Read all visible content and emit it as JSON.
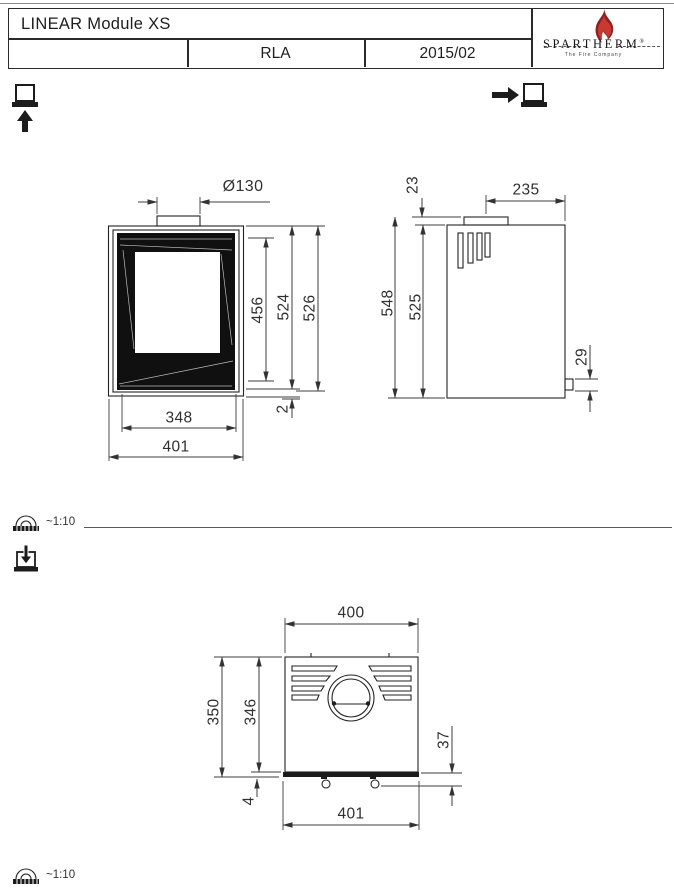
{
  "title_block": {
    "product_name": "LINEAR Module XS",
    "approval_code": "RLA",
    "revision_date": "2015/02",
    "brand_name": "SPARTHERM",
    "registered_mark": "®",
    "brand_tagline": "The Fire Company"
  },
  "connection_symbols": {
    "bottom_air_icon": "air-connection-bottom",
    "rear_air_icon": "air-connection-rear",
    "loading_icon": "load-from-top",
    "scale_icon": "protractor-scale"
  },
  "scales": {
    "front_scale": "~1:10",
    "bottom_scale": "~1:10"
  },
  "front_view": {
    "flue_diameter": "Ø130",
    "glass_height": "456",
    "door_height": "524",
    "total_height": "526",
    "bottom_edge": "2",
    "glass_width": "348",
    "body_width": "401"
  },
  "side_view": {
    "collar_offset": "23",
    "flue_axis_to_rear": "235",
    "total_height": "548",
    "body_height": "525",
    "outlet_height": "29"
  },
  "bottom_view": {
    "body_width": "400",
    "total_depth": "350",
    "body_depth": "346",
    "bracket_offset": "37",
    "front_edge": "4",
    "overall_width": "401"
  }
}
